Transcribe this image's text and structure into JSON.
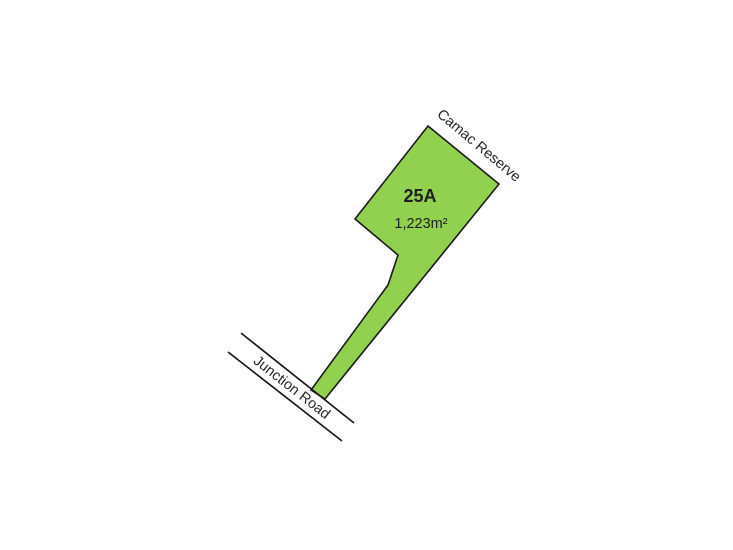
{
  "plan": {
    "lot": {
      "number": "25A",
      "area": "1,223m²"
    },
    "labels": {
      "reserve": "Camac Reserve",
      "road": "Junction Road"
    },
    "colors": {
      "parcel_fill": "#92d050",
      "outline": "#1a1a1a",
      "text": "#262626",
      "background": "#ffffff"
    }
  }
}
